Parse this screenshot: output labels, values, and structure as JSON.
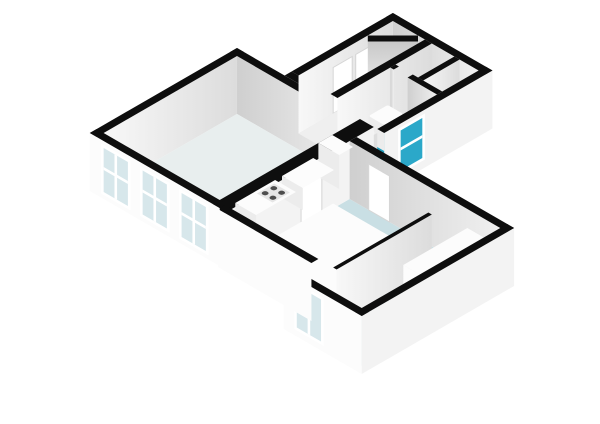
{
  "page": {
    "background": "#ffffff"
  },
  "colors": {
    "wall_top": "#0e0e0e",
    "inner_lit": "#f6f6f6",
    "inner_lit_dark": "#dcdcdc",
    "inner_shade": "#efefef",
    "inner_shade_dark": "#cfcfcf",
    "outer_bright": "#fcfcfc",
    "outer_mid": "#f3f3f3",
    "floor_living": "#e8eeee",
    "floor_rooms": "#efefef",
    "floor_bedroom": "#c9dfe4",
    "floor_bath": "#1f9cbc",
    "glass_light": "#d7e7eb",
    "glass_teal": "#2ba8c9",
    "frame_white": "#ffffff",
    "frame_gray": "#d6d6d6",
    "furn_top": "#fcfcfc",
    "furn_side": "#ececec",
    "furn_shade": "#dedede",
    "stove_body": "#e6e6e6",
    "stove_burner": "#4d4d4d",
    "diag_face_top": "#c9c9c9",
    "diag_face_bottom": "#f1f1f1"
  },
  "scene": {
    "type": "isometric-3d-floorplan-render",
    "view": "axonometric, rotated 45 degrees, white background, black wall caps",
    "wings": [
      {
        "name": "living-wing",
        "rooms": [
          {
            "name": "living-room-kitchen",
            "floor_color_key": "floor_living",
            "features": [
              "three-windows-sw-wall",
              "fridge-block",
              "kitchen-counter",
              "four-burner-stove",
              "door-to-bedroom-se-wall"
            ]
          }
        ]
      },
      {
        "name": "upper-wing",
        "rooms": [
          {
            "name": "hallway",
            "floor_color_key": "floor_rooms",
            "features": [
              "two-door-panels-nw-wall",
              "diagonal-corner-wall"
            ]
          },
          {
            "name": "storage-room-left",
            "floor_color_key": "floor_rooms"
          },
          {
            "name": "storage-room-right",
            "floor_color_key": "floor_rooms"
          },
          {
            "name": "bathroom",
            "floor_color_key": "floor_bath",
            "features": [
              "vanity-sink",
              "toilet",
              "teal-window-se-wall",
              "door-gap-north-wall"
            ]
          }
        ]
      },
      {
        "name": "bedroom-wing",
        "rooms": [
          {
            "name": "bedroom",
            "floor_color_key": "floor_bedroom",
            "features": [
              "platform-bed",
              "thin-partition-wall",
              "wardrobe-block",
              "window-sw-wall",
              "stepped-exterior-outline",
              "door-panel-ne-wall"
            ]
          }
        ]
      }
    ],
    "counts": {
      "windows": 5,
      "door_panels": 4,
      "door_gaps": 1
    }
  }
}
